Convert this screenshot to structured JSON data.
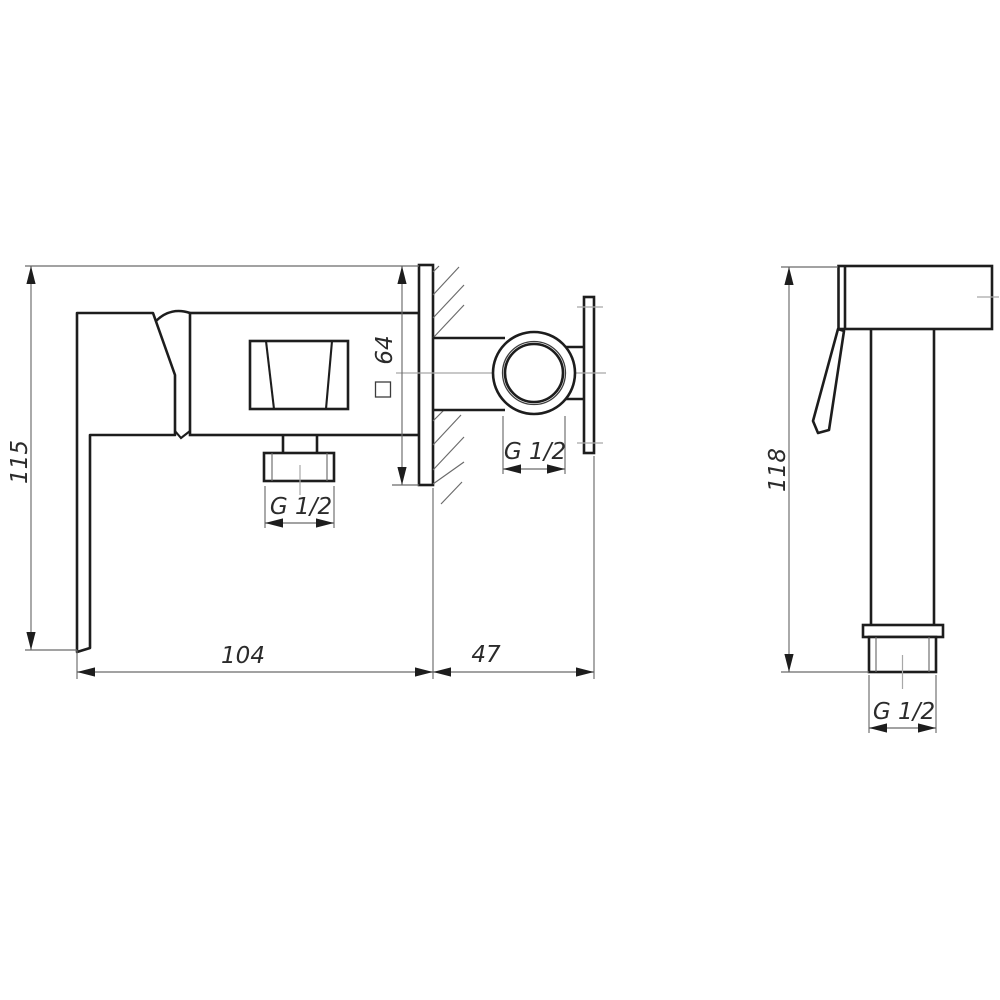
{
  "drawing_type": "technical drawing, two orthographic views of a wall-mounted bidet mixer and hand shower",
  "colors": {
    "background": "#ffffff",
    "outline": "#1d1d1d",
    "thin_line": "#6a6a6a",
    "centerline": "#a8a8a8",
    "text": "#2b2b2b"
  },
  "mixer_view": {
    "height_dim": "115",
    "width_dim": "104",
    "wall_offset_dim": "47",
    "flange_dim": "64",
    "flange_symbol": "square",
    "outlet_thread": "G 1/2",
    "inlet_thread": "G 1/2"
  },
  "shower_view": {
    "height_dim": "118",
    "thread": "G 1/2"
  }
}
